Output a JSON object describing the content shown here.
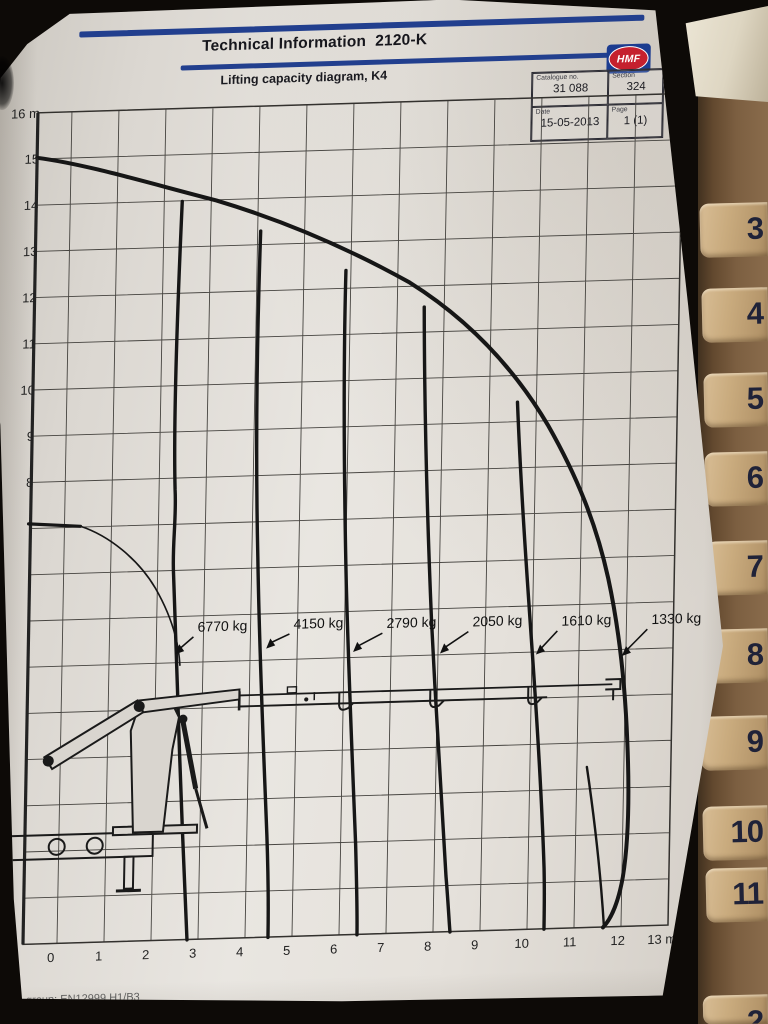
{
  "header": {
    "title": "Technical Information  2120-K",
    "subtitle": "Lifting capacity diagram, K4"
  },
  "logo": {
    "text": "HMF"
  },
  "info_box": {
    "cells": [
      {
        "label": "Catalogue no.",
        "value": "31 088"
      },
      {
        "label": "Section",
        "value": "324"
      },
      {
        "label": "Date",
        "value": "15-05-2013"
      },
      {
        "label": "Page",
        "value": "1 (1)"
      }
    ]
  },
  "footer": {
    "standard_text": "group: EN12999 H1/B3"
  },
  "binder_tabs": {
    "labels": [
      "3",
      "4",
      "5",
      "6",
      "7",
      "8",
      "9",
      "10",
      "11"
    ],
    "bottom_partial": "2"
  },
  "colors": {
    "accent_blue": "#223f8e",
    "logo_red": "#c5202e",
    "tab_face": "#c9ab7e",
    "paper": "#e9e6e1"
  },
  "chart_data": {
    "type": "line",
    "title": "Lifting capacity diagram, K4",
    "xlabel": "outreach (m)",
    "ylabel": "height (m)",
    "x_axis": {
      "ticks": [
        "-1",
        "0",
        "1",
        "2",
        "3",
        "4",
        "5",
        "6",
        "7",
        "8",
        "9",
        "10",
        "11",
        "12",
        "13 m"
      ],
      "range": [
        -1,
        13
      ]
    },
    "y_axis": {
      "ticks": [
        "16 m",
        "15",
        "14",
        "13",
        "12",
        "11",
        "10",
        "9",
        "8"
      ],
      "range_visible": [
        8,
        16
      ],
      "range_full": [
        -2,
        16
      ]
    },
    "grid": true,
    "legend_position": "inline-labels",
    "series": [
      {
        "name": "6770 kg",
        "type": "capacity-limit",
        "max_outreach_m": 2.8
      },
      {
        "name": "4150 kg",
        "type": "capacity-limit",
        "max_outreach_m": 4.5
      },
      {
        "name": "2790 kg",
        "type": "capacity-limit",
        "max_outreach_m": 6.4
      },
      {
        "name": "2050 kg",
        "type": "capacity-limit",
        "max_outreach_m": 8.4
      },
      {
        "name": "1610 kg",
        "type": "capacity-limit",
        "max_outreach_m": 10.4
      },
      {
        "name": "1330 kg",
        "type": "capacity-limit",
        "max_outreach_m": 11.9
      }
    ],
    "envelope_points_m": [
      [
        0,
        14.9
      ],
      [
        2,
        14.1
      ],
      [
        4.2,
        13.2
      ],
      [
        6.1,
        12.4
      ],
      [
        7.5,
        11.6
      ],
      [
        9,
        10.4
      ],
      [
        10.1,
        8.9
      ],
      [
        10.9,
        6.9
      ],
      [
        11.4,
        5.0
      ],
      [
        11.9,
        2.8
      ],
      [
        12.1,
        1.1
      ],
      [
        12.0,
        -0.5
      ],
      [
        11.6,
        -2.0
      ]
    ]
  }
}
